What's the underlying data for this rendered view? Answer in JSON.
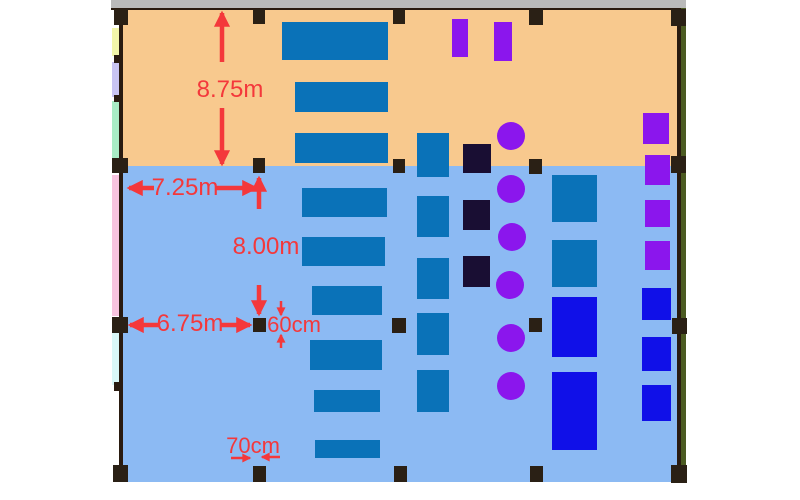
{
  "floorplan": {
    "palette": {
      "top_bar": "#BABABA",
      "wall": "#2A1B10",
      "column": "#2A2015",
      "zone_upper": "#F8C98E",
      "zone_lower": "#8CBAF3",
      "desk_blue": "#0A72B8",
      "royal_blue": "#1010E8",
      "purple": "#8B16ED",
      "navy": "#190E33",
      "dim_red": "#F4383B",
      "strip_yellow": "#F2F5A9",
      "strip_lavender": "#C9C4F2",
      "strip_mint": "#A9ECC5",
      "strip_pink": "#F7C3DE",
      "strip_cyan": "#D9F7F7",
      "strip_olive": "#4C5B22"
    },
    "zones": [
      {
        "name": "zone-upper",
        "x": 123,
        "y": 10,
        "w": 554,
        "h": 156,
        "c": "zone_upper"
      },
      {
        "name": "zone-lower",
        "x": 123,
        "y": 166,
        "w": 554,
        "h": 316,
        "c": "zone_lower"
      }
    ],
    "frame": [
      {
        "name": "top-bar",
        "x": 111,
        "y": 0,
        "w": 575,
        "h": 8,
        "c": "top_bar"
      },
      {
        "name": "top-wall",
        "x": 111,
        "y": 8,
        "w": 575,
        "h": 2,
        "c": "wall"
      },
      {
        "name": "left-wall",
        "x": 119,
        "y": 8,
        "w": 4,
        "h": 474,
        "c": "wall"
      },
      {
        "name": "right-wall",
        "x": 677,
        "y": 8,
        "w": 4,
        "h": 474,
        "c": "wall"
      },
      {
        "name": "right-strip",
        "x": 681,
        "y": 8,
        "w": 5,
        "h": 474,
        "c": "strip_olive"
      },
      {
        "name": "left-strip-yellow",
        "x": 112,
        "y": 28,
        "w": 7,
        "h": 28,
        "c": "strip_yellow"
      },
      {
        "name": "left-strip-lavender",
        "x": 112,
        "y": 62,
        "w": 7,
        "h": 35,
        "c": "strip_lavender"
      },
      {
        "name": "left-strip-mint",
        "x": 112,
        "y": 101,
        "w": 7,
        "h": 57,
        "c": "strip_mint"
      },
      {
        "name": "left-strip-pink",
        "x": 112,
        "y": 175,
        "w": 7,
        "h": 141,
        "c": "strip_pink"
      },
      {
        "name": "left-strip-cyan",
        "x": 112,
        "y": 333,
        "w": 7,
        "h": 52,
        "c": "strip_cyan"
      },
      {
        "name": "wall-tick",
        "x": 114,
        "y": 55,
        "w": 9,
        "h": 8,
        "c": "wall"
      },
      {
        "name": "wall-tick",
        "x": 114,
        "y": 95,
        "w": 9,
        "h": 7,
        "c": "wall"
      },
      {
        "name": "wall-tick",
        "x": 114,
        "y": 382,
        "w": 9,
        "h": 9,
        "c": "wall"
      }
    ],
    "columns": [
      {
        "x": 114,
        "y": 9,
        "w": 14,
        "h": 16
      },
      {
        "x": 253,
        "y": 9,
        "w": 12,
        "h": 15
      },
      {
        "x": 393,
        "y": 9,
        "w": 12,
        "h": 15
      },
      {
        "x": 529,
        "y": 9,
        "w": 14,
        "h": 16
      },
      {
        "x": 671,
        "y": 9,
        "w": 15,
        "h": 17
      },
      {
        "x": 112,
        "y": 158,
        "w": 16,
        "h": 15
      },
      {
        "x": 253,
        "y": 158,
        "w": 12,
        "h": 15
      },
      {
        "x": 393,
        "y": 159,
        "w": 12,
        "h": 14
      },
      {
        "x": 529,
        "y": 159,
        "w": 13,
        "h": 15
      },
      {
        "x": 671,
        "y": 156,
        "w": 15,
        "h": 17
      },
      {
        "x": 112,
        "y": 317,
        "w": 16,
        "h": 16
      },
      {
        "x": 253,
        "y": 318,
        "w": 13,
        "h": 14
      },
      {
        "x": 392,
        "y": 318,
        "w": 14,
        "h": 15
      },
      {
        "x": 529,
        "y": 318,
        "w": 13,
        "h": 14
      },
      {
        "x": 672,
        "y": 318,
        "w": 15,
        "h": 16
      },
      {
        "x": 113,
        "y": 465,
        "w": 15,
        "h": 17
      },
      {
        "x": 253,
        "y": 466,
        "w": 13,
        "h": 16
      },
      {
        "x": 394,
        "y": 466,
        "w": 13,
        "h": 16
      },
      {
        "x": 530,
        "y": 466,
        "w": 13,
        "h": 16
      },
      {
        "x": 671,
        "y": 465,
        "w": 16,
        "h": 18
      }
    ],
    "furniture": [
      {
        "x": 282,
        "y": 22,
        "w": 106,
        "h": 38,
        "c": "desk_blue"
      },
      {
        "x": 295,
        "y": 82,
        "w": 93,
        "h": 30,
        "c": "desk_blue"
      },
      {
        "x": 295,
        "y": 133,
        "w": 93,
        "h": 30,
        "c": "desk_blue"
      },
      {
        "x": 302,
        "y": 188,
        "w": 85,
        "h": 29,
        "c": "desk_blue"
      },
      {
        "x": 302,
        "y": 237,
        "w": 83,
        "h": 29,
        "c": "desk_blue"
      },
      {
        "x": 312,
        "y": 286,
        "w": 70,
        "h": 29,
        "c": "desk_blue"
      },
      {
        "x": 310,
        "y": 340,
        "w": 72,
        "h": 30,
        "c": "desk_blue"
      },
      {
        "x": 314,
        "y": 390,
        "w": 66,
        "h": 22,
        "c": "desk_blue"
      },
      {
        "x": 315,
        "y": 440,
        "w": 65,
        "h": 18,
        "c": "desk_blue"
      },
      {
        "x": 417,
        "y": 133,
        "w": 32,
        "h": 44,
        "c": "desk_blue"
      },
      {
        "x": 417,
        "y": 196,
        "w": 32,
        "h": 41,
        "c": "desk_blue"
      },
      {
        "x": 417,
        "y": 258,
        "w": 32,
        "h": 41,
        "c": "desk_blue"
      },
      {
        "x": 417,
        "y": 313,
        "w": 32,
        "h": 42,
        "c": "desk_blue"
      },
      {
        "x": 417,
        "y": 370,
        "w": 32,
        "h": 42,
        "c": "desk_blue"
      },
      {
        "x": 552,
        "y": 175,
        "w": 45,
        "h": 47,
        "c": "desk_blue"
      },
      {
        "x": 552,
        "y": 240,
        "w": 45,
        "h": 47,
        "c": "desk_blue"
      },
      {
        "x": 552,
        "y": 297,
        "w": 45,
        "h": 60,
        "c": "royal_blue"
      },
      {
        "x": 552,
        "y": 372,
        "w": 45,
        "h": 78,
        "c": "royal_blue"
      },
      {
        "x": 642,
        "y": 288,
        "w": 29,
        "h": 32,
        "c": "royal_blue"
      },
      {
        "x": 642,
        "y": 337,
        "w": 29,
        "h": 34,
        "c": "royal_blue"
      },
      {
        "x": 642,
        "y": 385,
        "w": 29,
        "h": 36,
        "c": "royal_blue"
      },
      {
        "x": 452,
        "y": 19,
        "w": 16,
        "h": 38,
        "c": "purple"
      },
      {
        "x": 494,
        "y": 22,
        "w": 18,
        "h": 39,
        "c": "purple"
      },
      {
        "x": 643,
        "y": 113,
        "w": 26,
        "h": 31,
        "c": "purple"
      },
      {
        "x": 645,
        "y": 155,
        "w": 25,
        "h": 30,
        "c": "purple"
      },
      {
        "x": 645,
        "y": 200,
        "w": 25,
        "h": 27,
        "c": "purple"
      },
      {
        "x": 645,
        "y": 241,
        "w": 25,
        "h": 29,
        "c": "purple"
      },
      {
        "x": 463,
        "y": 144,
        "w": 28,
        "h": 29,
        "c": "navy"
      },
      {
        "x": 463,
        "y": 200,
        "w": 27,
        "h": 30,
        "c": "navy"
      },
      {
        "x": 463,
        "y": 256,
        "w": 27,
        "h": 31,
        "c": "navy"
      }
    ],
    "circles": [
      {
        "cx": 511,
        "cy": 136,
        "r": 14
      },
      {
        "cx": 511,
        "cy": 189,
        "r": 14
      },
      {
        "cx": 512,
        "cy": 237,
        "r": 14
      },
      {
        "cx": 510,
        "cy": 285,
        "r": 14
      },
      {
        "cx": 511,
        "cy": 338,
        "r": 14
      },
      {
        "cx": 511,
        "cy": 386,
        "r": 14
      }
    ],
    "arrows": [
      {
        "x1": 222,
        "y1": 62,
        "x2": 222,
        "y2": 13,
        "s": 4.5
      },
      {
        "x1": 222,
        "y1": 108,
        "x2": 222,
        "y2": 164,
        "s": 4.5
      },
      {
        "x1": 154,
        "y1": 188,
        "x2": 129,
        "y2": 188,
        "s": 4.5
      },
      {
        "x1": 216,
        "y1": 188,
        "x2": 256,
        "y2": 188,
        "s": 4.5
      },
      {
        "x1": 259,
        "y1": 209,
        "x2": 259,
        "y2": 178,
        "s": 4.5
      },
      {
        "x1": 259,
        "y1": 285,
        "x2": 259,
        "y2": 314,
        "s": 4.5
      },
      {
        "x1": 159,
        "y1": 325,
        "x2": 130,
        "y2": 325,
        "s": 4.5
      },
      {
        "x1": 221,
        "y1": 325,
        "x2": 250,
        "y2": 325,
        "s": 4.5
      },
      {
        "x1": 281,
        "y1": 301,
        "x2": 281,
        "y2": 315,
        "s": 2.5
      },
      {
        "x1": 281,
        "y1": 348,
        "x2": 281,
        "y2": 335,
        "s": 2.5
      },
      {
        "x1": 231,
        "y1": 458,
        "x2": 250,
        "y2": 458,
        "s": 2.5
      },
      {
        "x1": 280,
        "y1": 457,
        "x2": 262,
        "y2": 457,
        "s": 2.5
      }
    ],
    "dimension_labels": [
      {
        "id": "dim-height-upper",
        "text": "8.75m",
        "x": 230,
        "y": 90
      },
      {
        "id": "dim-width-upper",
        "text": "7.25m",
        "x": 185,
        "y": 188
      },
      {
        "id": "dim-height-lower",
        "text": "8.00m",
        "x": 266,
        "y": 247
      },
      {
        "id": "dim-width-lower",
        "text": "6.75m",
        "x": 190,
        "y": 324
      },
      {
        "id": "dim-column-depth",
        "text": "60cm",
        "x": 294,
        "y": 325
      },
      {
        "id": "dim-column-width",
        "text": "70cm",
        "x": 253,
        "y": 446
      }
    ]
  }
}
